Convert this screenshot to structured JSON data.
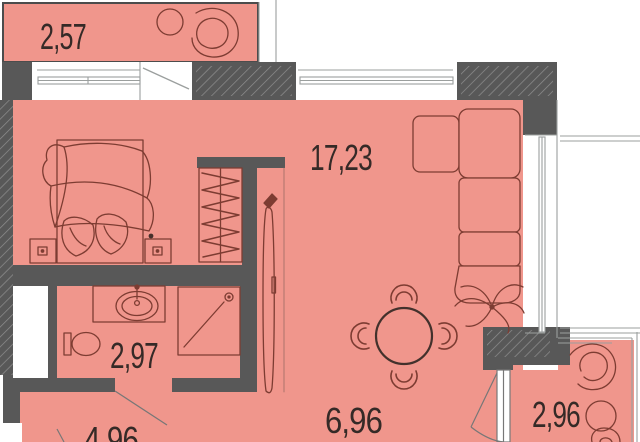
{
  "plan_labels": {
    "balcony_top": "2,57",
    "living_room": "17,23",
    "bathroom": "2,97",
    "hallway": "4,96",
    "kitchen": "6,96",
    "balcony_right": "2,96"
  },
  "colors": {
    "room_fill": "#f0968c",
    "wall_fill": "#585858",
    "hatch_line": "#8f8f8f",
    "furniture_line": "#7d3c32",
    "window_line": "#9b9f9e",
    "label_text": "#352a27"
  }
}
